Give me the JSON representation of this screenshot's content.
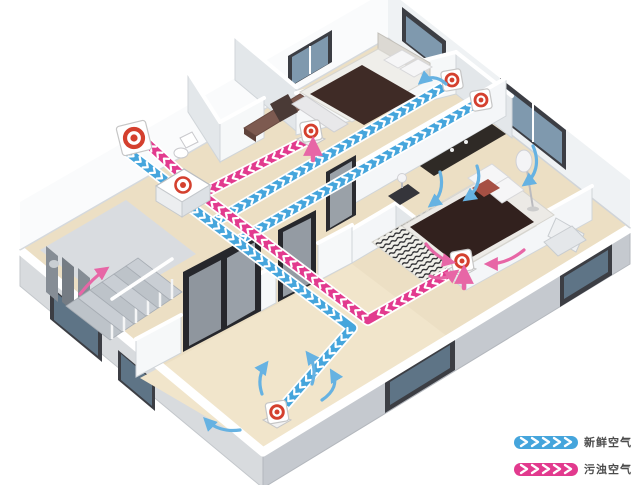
{
  "diagram": {
    "legend": {
      "items": [
        {
          "id": "fresh",
          "label": "新鲜空气",
          "color": "#45a5dc"
        },
        {
          "id": "polluted",
          "label": "污浊空气",
          "color": "#e23a8e"
        }
      ]
    },
    "colors": {
      "fresh_air": "#45a5dc",
      "polluted_air": "#e23a8e",
      "fresh_flow_arrow": "#66b2e2",
      "polluted_flow_arrow": "#e766a6",
      "diffuser_accent": "#d4402e",
      "duct_chevron": "#ffffff"
    },
    "icons": {
      "outdoor_vent": "outdoor-vent-icon",
      "hrv_unit": "hrv-unit-icon",
      "supply_diffusers": [
        "supply-diffuser-bedroom1-icon",
        "supply-diffuser-master-icon",
        "supply-diffuser-living-icon"
      ],
      "extract_diffusers": [
        "extract-diffuser-hall-icon",
        "extract-diffuser-master-icon"
      ]
    }
  }
}
